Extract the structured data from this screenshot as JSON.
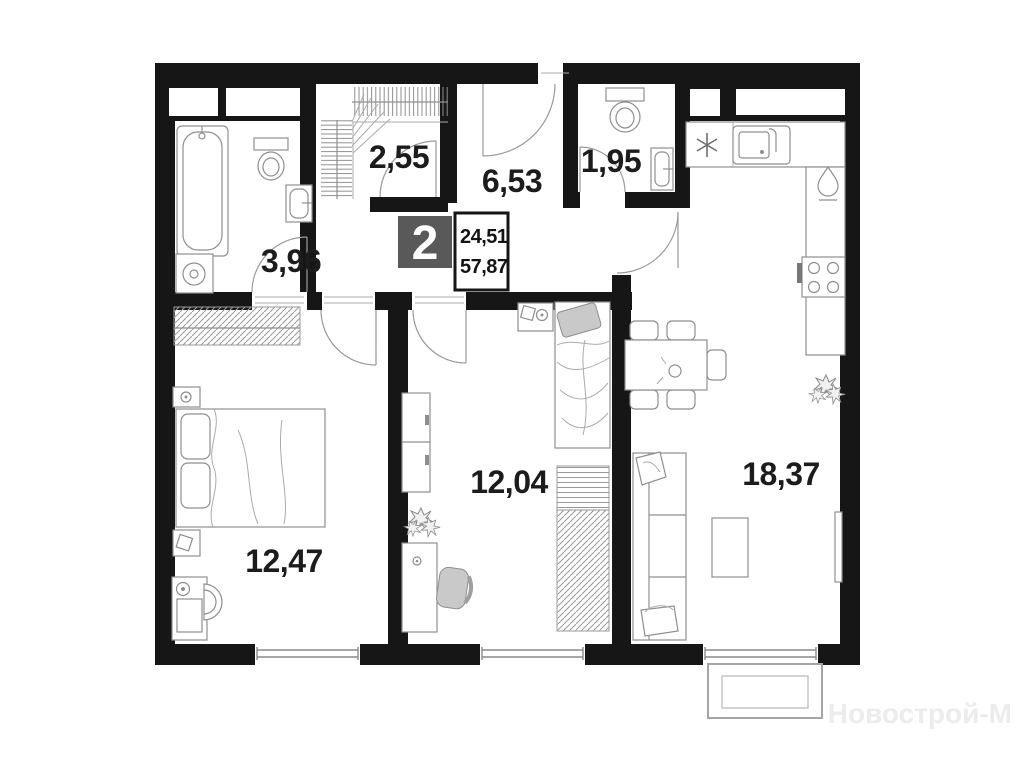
{
  "floorplan": {
    "badge": {
      "rooms_count": "2"
    },
    "areas": {
      "living": "24,51",
      "total": "57,87"
    },
    "rooms": {
      "wardrobe": "2,55",
      "hallway": "6,53",
      "wc": "1,95",
      "bathroom": "3,96",
      "bedroom_left": "12,47",
      "bedroom_middle": "12,04",
      "kitchen_living": "18,37"
    },
    "watermark": "Новострой-М",
    "colors": {
      "wall": "#161616",
      "badge_bg": "#595959",
      "furniture_line": "#8f8f8f",
      "watermark": "#ececec"
    }
  }
}
